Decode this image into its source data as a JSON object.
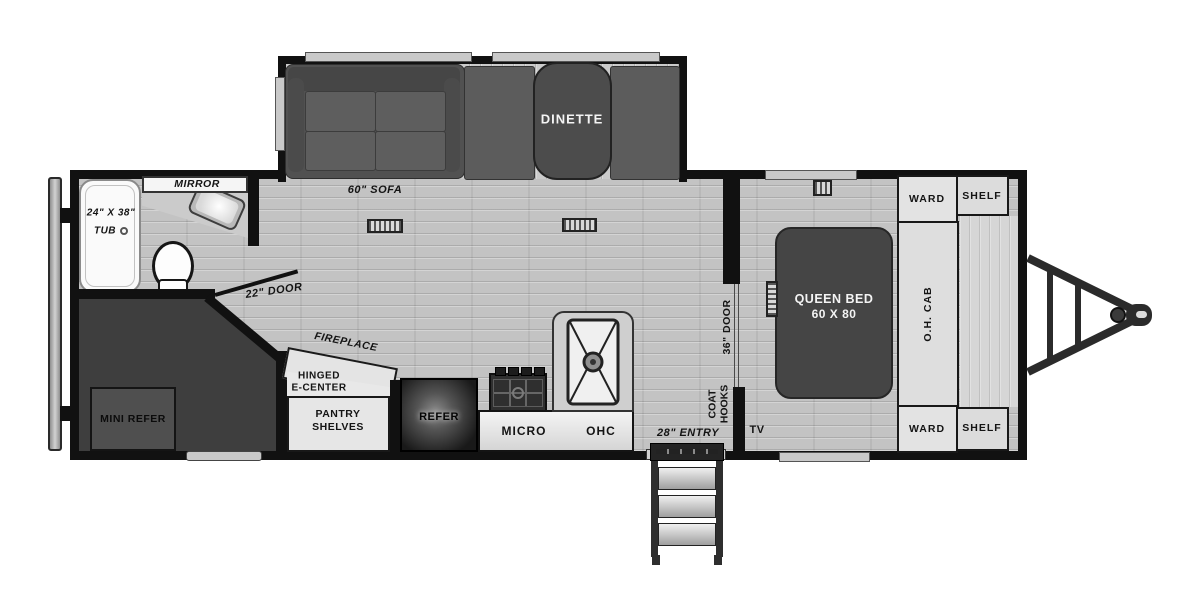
{
  "colors": {
    "wall": "#111111",
    "floor": "#c3c3c3",
    "dark_furniture": "#454545",
    "cabinet": "#e3e3e3",
    "fixture_white": "#fafafa"
  },
  "floorplan": {
    "bathroom": {
      "tub_size": "24\" X 38\"",
      "tub": "TUB",
      "mirror": "MIRROR",
      "door": "22\" DOOR"
    },
    "living_area": {
      "sofa": "60\" SOFA",
      "dinette": "DINETTE",
      "fireplace": "FIREPLACE",
      "hinged_line1": "HINGED",
      "hinged_line2": "E-CENTER",
      "pantry_line1": "PANTRY",
      "pantry_line2": "SHELVES",
      "tv": "TV",
      "coat_hooks_line1": "COAT",
      "coat_hooks_line2": "HOOKS"
    },
    "front_storage": {
      "mini_refer": "MINI REFER"
    },
    "kitchen": {
      "refer": "REFER",
      "micro": "MICRO",
      "ohc": "OHC"
    },
    "entry": {
      "door": "28\" ENTRY"
    },
    "bedroom": {
      "door": "36\" DOOR",
      "bed_line1": "QUEEN BED",
      "bed_line2": "60 X 80",
      "ward_top": "WARD",
      "shelf_top": "SHELF",
      "oh_cab": "O.H. CAB",
      "ward_bottom": "WARD",
      "shelf_bottom": "SHELF"
    }
  }
}
